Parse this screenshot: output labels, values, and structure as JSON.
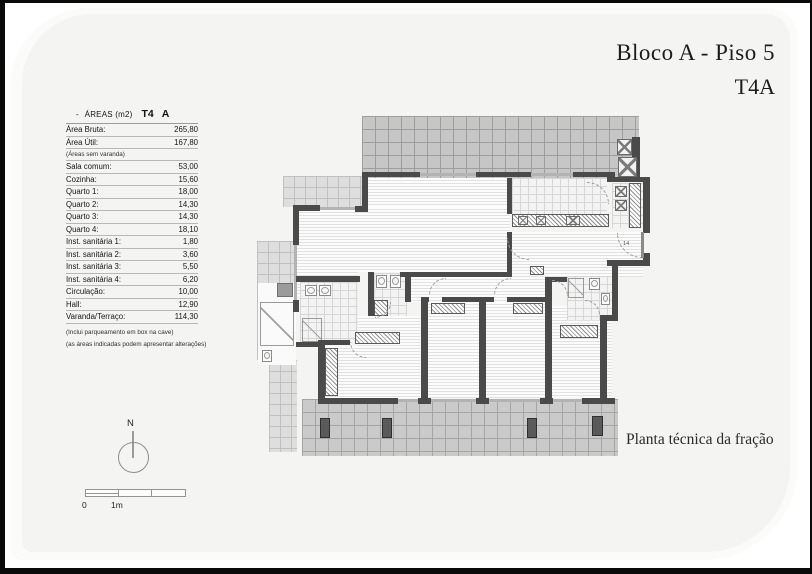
{
  "header": {
    "title": "Bloco A - Piso 5",
    "subtitle": "T4A"
  },
  "areas_table": {
    "header": {
      "dash": "-",
      "label": "ÁREAS (m2)",
      "type": "T4",
      "block": "A"
    },
    "rows": [
      {
        "label": "Área Bruta:",
        "value": "265,80"
      },
      {
        "label": "Área Útil:",
        "value": "167,80"
      },
      {
        "label": "(Áreas sem varanda)",
        "value": "",
        "small": true
      },
      {
        "label": "Sala comum:",
        "value": "53,00"
      },
      {
        "label": "Cozinha:",
        "value": "15,60"
      },
      {
        "label": "Quarto 1:",
        "value": "18,00"
      },
      {
        "label": "Quarto 2:",
        "value": "14,30"
      },
      {
        "label": "Quarto 3:",
        "value": "14,30"
      },
      {
        "label": "Quarto 4:",
        "value": "18,10"
      },
      {
        "label": "Inst. sanitária 1:",
        "value": "1,80"
      },
      {
        "label": "Inst. sanitária 2:",
        "value": "3,60"
      },
      {
        "label": "Inst. sanitária 3:",
        "value": "5,50"
      },
      {
        "label": "Inst. sanitária 4:",
        "value": "6,20"
      },
      {
        "label": "Circulação:",
        "value": "10,00"
      },
      {
        "label": "Hall:",
        "value": "12,90"
      },
      {
        "label": "Varanda/Terraço:",
        "value": "114,30"
      }
    ],
    "footnotes": [
      "(Inclui parqueamento em box na cave)",
      "(as áreas indicadas podem apresentar alterações)"
    ]
  },
  "compass": {
    "north_label": "N"
  },
  "scale_bar": {
    "zero_label": "0",
    "one_meter_label": "1m"
  },
  "plan": {
    "caption": "Planta técnica da fração",
    "entrance_door_label": "14"
  },
  "colors": {
    "wall": "#4a4a4a",
    "terrace_grid": "#c6c6c6",
    "panel": "#f4f4f3",
    "frame": "#0a0a0a"
  }
}
